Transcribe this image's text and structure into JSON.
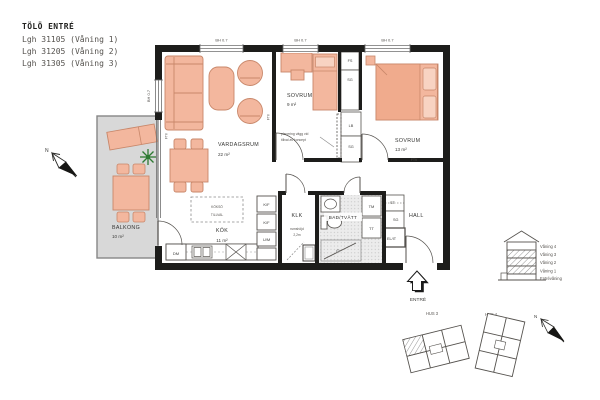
{
  "title_block": {
    "title": "TÖLÖ ENTRÉ",
    "apartments": [
      "Lgh 31105 (Våning 1)",
      "Lgh 31205 (Våning 2)",
      "Lgh 31305 (Våning 3)"
    ]
  },
  "rooms": {
    "vardagsrum": {
      "name": "VARDAGSRUM",
      "area": "22 m²"
    },
    "kok": {
      "name": "KÖK",
      "area": "11 m²"
    },
    "sovrum_9": {
      "name": "SOVRUM",
      "area": "9 m²"
    },
    "sovrum_13": {
      "name": "SOVRUM",
      "area": "13 m²"
    },
    "balkong": {
      "name": "BALKONG",
      "area": "10 m²"
    },
    "klk": {
      "name": "KLK"
    },
    "bad_tvatt": {
      "name": "BAD/TVÄTT"
    },
    "hall": {
      "name": "HALL"
    }
  },
  "fixtures": {
    "dm": "DM",
    "kf": "K/F",
    "um": "U/M",
    "tm": "TM",
    "tt": "TT",
    "st": "ST",
    "sg": "SG",
    "el_it": "EL/IT",
    "fs": "FS",
    "lb": "LB"
  },
  "labels": {
    "window_head_height": "BH 0.7",
    "ftv": "FTV",
    "kokso_line1": "KÖKSÖ",
    "kokso_line2": "TILLVAL",
    "ceiling_line1": "rumshöjd",
    "ceiling_line2": "2,2m",
    "wall_note_line1": "placering vägg vid",
    "wall_note_line2": "tillval av koncept",
    "entre": "ENTRÉ"
  },
  "legend": {
    "section_floors": [
      "Våning 4",
      "Våning 3",
      "Våning 2",
      "Våning 1",
      "Entrévåning"
    ],
    "hus3": "HUS 3",
    "hus4": "HUS 4",
    "north": "N"
  },
  "colors": {
    "wall": "#1d1d1b",
    "furniture_fill": "#f3b79e",
    "furniture_accent": "#f0ab8d",
    "pillow_fill": "#f8d3c2",
    "furniture_stroke": "#c8876a",
    "balcony_fill": "#d8d8d8",
    "plant_green": "#2f7a33",
    "text": "#3c3c3a"
  }
}
